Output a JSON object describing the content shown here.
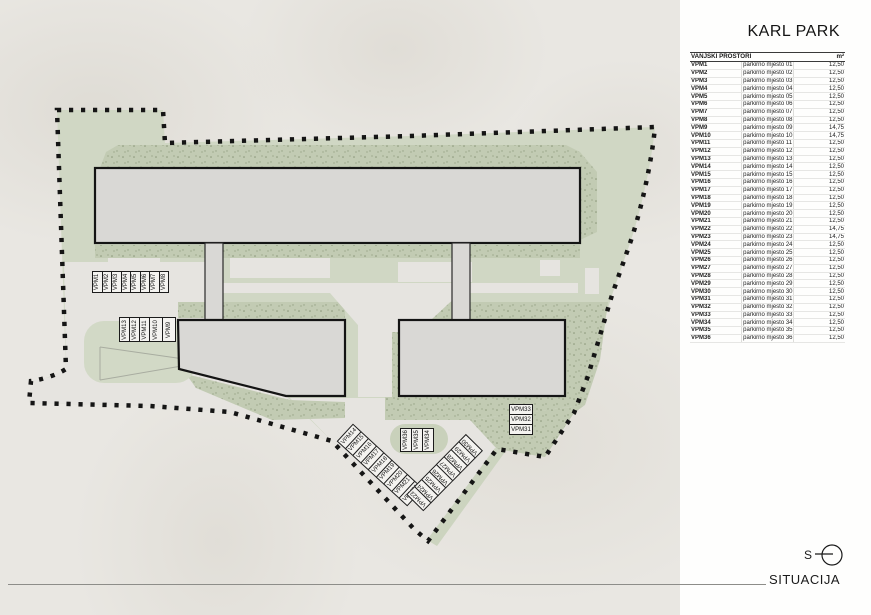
{
  "panel": {
    "title": "KARL PARK",
    "caption": "SITUACIJA",
    "north_label": "S",
    "table": {
      "header": {
        "name": "VANJSKI PROSTORI",
        "area": "m²"
      },
      "rows": [
        {
          "code": "VPM1",
          "desc": "parkirno mjesto 01",
          "area": "12,50"
        },
        {
          "code": "VPM2",
          "desc": "parkirno mjesto 02",
          "area": "12,50"
        },
        {
          "code": "VPM3",
          "desc": "parkirno mjesto 03",
          "area": "12,50"
        },
        {
          "code": "VPM4",
          "desc": "parkirno mjesto 04",
          "area": "12,50"
        },
        {
          "code": "VPM5",
          "desc": "parkirno mjesto 05",
          "area": "12,50"
        },
        {
          "code": "VPM6",
          "desc": "parkirno mjesto 06",
          "area": "12,50"
        },
        {
          "code": "VPM7",
          "desc": "parkirno mjesto 07",
          "area": "12,50"
        },
        {
          "code": "VPM8",
          "desc": "parkirno mjesto 08",
          "area": "12,50"
        },
        {
          "code": "VPM9",
          "desc": "parkirno mjesto 09 - invalidsko",
          "area": "14,75"
        },
        {
          "code": "VPM10",
          "desc": "parkirno mjesto 10 - invalidsko",
          "area": "14,75"
        },
        {
          "code": "VPM11",
          "desc": "parkirno mjesto 11",
          "area": "12,50"
        },
        {
          "code": "VPM12",
          "desc": "parkirno mjesto 12",
          "area": "12,50"
        },
        {
          "code": "VPM13",
          "desc": "parkirno mjesto 13",
          "area": "12,50"
        },
        {
          "code": "VPM14",
          "desc": "parkirno mjesto 14",
          "area": "12,50"
        },
        {
          "code": "VPM15",
          "desc": "parkirno mjesto 15",
          "area": "12,50"
        },
        {
          "code": "VPM16",
          "desc": "parkirno mjesto 16",
          "area": "12,50"
        },
        {
          "code": "VPM17",
          "desc": "parkirno mjesto 17",
          "area": "12,50"
        },
        {
          "code": "VPM18",
          "desc": "parkirno mjesto 18",
          "area": "12,50"
        },
        {
          "code": "VPM19",
          "desc": "parkirno mjesto 19",
          "area": "12,50"
        },
        {
          "code": "VPM20",
          "desc": "parkirno mjesto 20",
          "area": "12,50"
        },
        {
          "code": "VPM21",
          "desc": "parkirno mjesto 21",
          "area": "12,50"
        },
        {
          "code": "VPM22",
          "desc": "parkirno mjesto 22 - invalidsko",
          "area": "14,75"
        },
        {
          "code": "VPM23",
          "desc": "parkirno mjesto 23 - invalidsko",
          "area": "14,75"
        },
        {
          "code": "VPM24",
          "desc": "parkirno mjesto 24",
          "area": "12,50"
        },
        {
          "code": "VPM25",
          "desc": "parkirno mjesto 25",
          "area": "12,50"
        },
        {
          "code": "VPM26",
          "desc": "parkirno mjesto 26",
          "area": "12,50"
        },
        {
          "code": "VPM27",
          "desc": "parkirno mjesto 27",
          "area": "12,50"
        },
        {
          "code": "VPM28",
          "desc": "parkirno mjesto 28",
          "area": "12,50"
        },
        {
          "code": "VPM29",
          "desc": "parkirno mjesto 29",
          "area": "12,50"
        },
        {
          "code": "VPM30",
          "desc": "parkirno mjesto 30",
          "area": "12,50"
        },
        {
          "code": "VPM31",
          "desc": "parkirno mjesto 31",
          "area": "12,50"
        },
        {
          "code": "VPM32",
          "desc": "parkirno mjesto 32",
          "area": "12,50"
        },
        {
          "code": "VPM33",
          "desc": "parkirno mjesto 33",
          "area": "12,50"
        },
        {
          "code": "VPM34",
          "desc": "parkirno mjesto 34",
          "area": "12,50"
        },
        {
          "code": "VPM35",
          "desc": "parkirno mjesto 35",
          "area": "12,50"
        },
        {
          "code": "VPM36",
          "desc": "parkirno mjesto 36",
          "area": "12,50"
        }
      ]
    }
  },
  "plan": {
    "labels": {
      "row_top": [
        "VPM1",
        "VPM2",
        "VPM3",
        "VPM4",
        "VPM5",
        "VPM6",
        "VPM7",
        "VPM8"
      ],
      "row_mid": [
        "VPM13",
        "VPM12",
        "VPM11",
        "VPM10",
        "VPM9"
      ],
      "diag_left": [
        "VPM14",
        "VPM15",
        "VPM16",
        "VPM17",
        "VPM18",
        "VPM19",
        "VPM20",
        "VPM21",
        "VPM22"
      ],
      "diag_right": [
        "VPM23",
        "VPM24",
        "VPM25",
        "VPM26",
        "VPM27",
        "VPM28",
        "VPM29",
        "VPM30"
      ],
      "stack_right": [
        "VPM33",
        "VPM32",
        "VPM31"
      ],
      "row_center": [
        "VPM36",
        "VPM35",
        "VPM34"
      ]
    },
    "colors": {
      "background": "#e9e7e2",
      "panel": "#fefefd",
      "site_green": "#d0d7c4",
      "speckled_green": "#c2cbb3",
      "pavement": "#e6e4e0",
      "building_fill": "#d9d8d5",
      "outline": "#141414",
      "boundary": "#151515"
    }
  }
}
